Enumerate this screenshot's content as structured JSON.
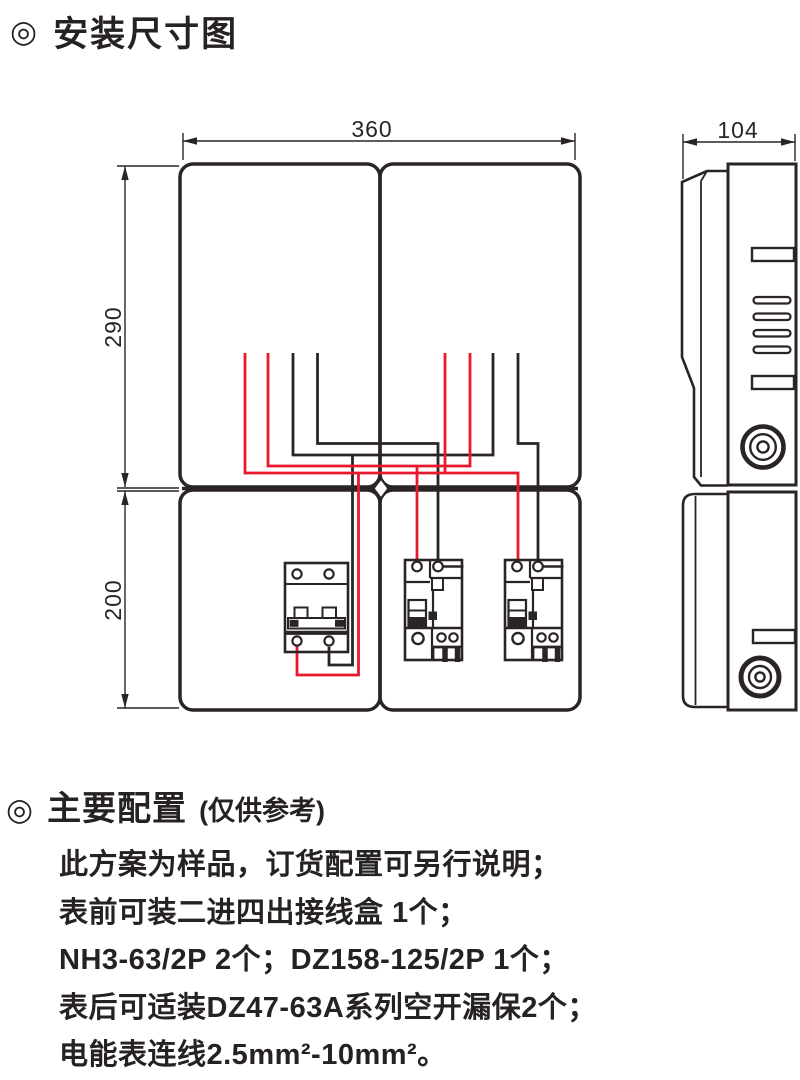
{
  "icons": {
    "bullseye": "◎"
  },
  "sections": {
    "install_title": "安装尺寸图",
    "config_title": "主要配置",
    "config_note": "(仅供参考)"
  },
  "diagram": {
    "dimensions": {
      "width": "360",
      "height_upper": "290",
      "height_lower": "200",
      "depth": "104"
    },
    "colors": {
      "outline": "#2a2425",
      "wire_live_red": "#e8192d",
      "wire_neutral_black": "#2a2425"
    }
  },
  "config": {
    "lines": [
      "此方案为样品，订货配置可另行说明；",
      "表前可装二进四出接线盒 1个；",
      "NH3-63/2P 2个；DZ158-125/2P 1个；",
      "表后可适装DZ47-63A系列空开漏保2个；",
      "电能表连线2.5mm²-10mm²。"
    ]
  }
}
